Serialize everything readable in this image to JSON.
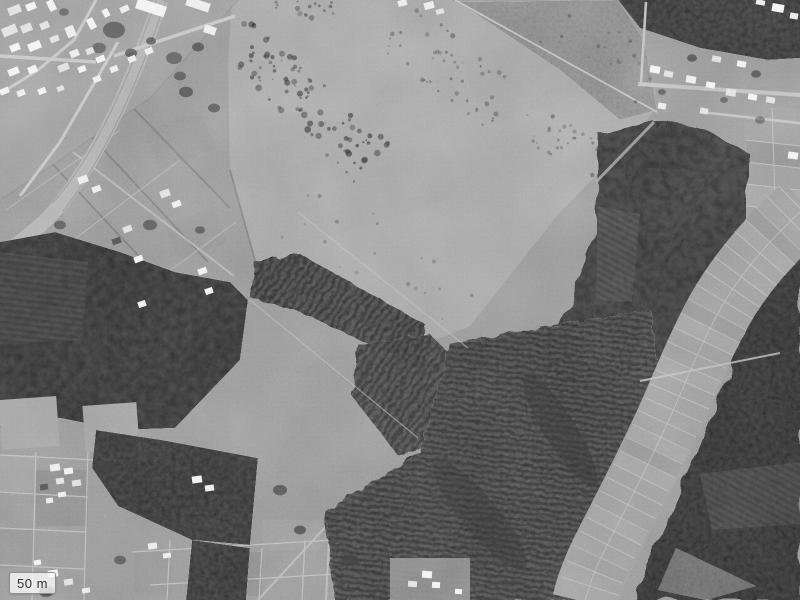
{
  "scale_control": {
    "label": "50 m"
  },
  "palette": {
    "field_base": "#9a9a9a",
    "field_light": "#a8a8a8",
    "forest_dark": "#4a4a4a",
    "plantation_rows": "#515151",
    "road_light": "#c4c4c4",
    "railway": "#b2b2b2",
    "building_roof": "#ededed",
    "paddy_floor": "#9e9e9e",
    "paddy_boundary": "#c3c3c3",
    "scale_text": "#333333",
    "scale_background": "rgba(255,255,255,0.75)"
  }
}
